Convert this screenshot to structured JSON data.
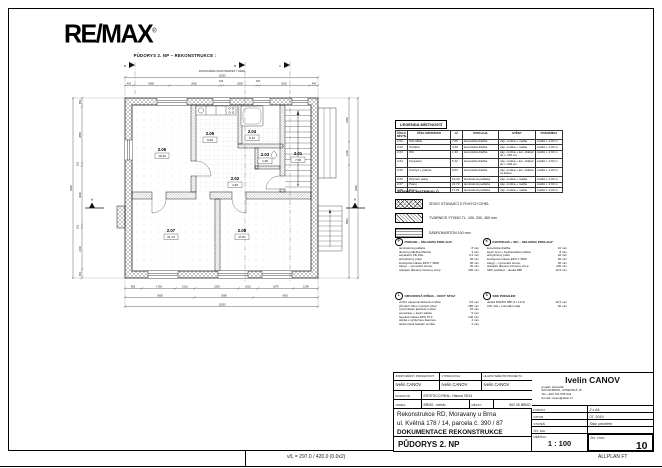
{
  "page": {
    "logo": "RE/MAX",
    "logo_reg": "®",
    "drawing_title": "PŮDORYS 2. NP – REKONSTRUKCE :",
    "footer_left": "v/L = 297.0 / 420.0 (0.0x2)",
    "footer_right": "ALLPLAN FT"
  },
  "plan": {
    "cut_note": "ROVINA ŘEZU NAD PARAPETY OKEN",
    "section_letter": "A",
    "flags": [
      "B",
      "B",
      "C"
    ],
    "rooms": [
      {
        "no": "2.01",
        "area": "7,06"
      },
      {
        "no": "2.02",
        "area": "4,49"
      },
      {
        "no": "2.03",
        "area": "1,30"
      },
      {
        "no": "2.04",
        "area": "5,12"
      },
      {
        "no": "2.05",
        "area": "6,03"
      },
      {
        "no": "2.06",
        "area": "19,43"
      },
      {
        "no": "2.07",
        "area": "21,73"
      },
      {
        "no": "2.08",
        "area": "17,81"
      }
    ],
    "dims": {
      "top_total": "10150",
      "top": [
        "450",
        "1880",
        "2650",
        "150",
        "1800",
        "150",
        "2620",
        "450"
      ],
      "bottom1": [
        "890",
        "1760",
        "1010",
        "2320",
        "1010",
        "1870",
        "1290"
      ],
      "bottom2": [
        "3650",
        "3080",
        "3420"
      ],
      "bottom_total": "10150",
      "left": [
        "450",
        "2890",
        "150",
        "3030",
        "150",
        "2140",
        "450"
      ],
      "left_total": "9260",
      "right": [
        "2250",
        "1200",
        "5810"
      ],
      "right_total": "9260"
    }
  },
  "legend_rooms": {
    "title": "LEGENDA MÍSTNOSTÍ",
    "columns": [
      "ČÍSLO MÍSTN.",
      "ÚČEL MÍSTNOSTI",
      "m²",
      "PODLAHA",
      "STĚNY",
      "POZNÁMKA"
    ],
    "rows": [
      [
        "2.01",
        "Schodiště",
        "7,06",
        "keramická dlažba",
        "váp. omítka + malba",
        "světlá v. 2,60 m"
      ],
      [
        "2.02",
        "Chodba",
        "4,49",
        "keramická dlažba",
        "váp. omítka + malba",
        "světlá v. 2,60 m"
      ],
      [
        "2.03",
        "WC",
        "1,30",
        "keramická dlažba",
        "váp. omítka + ker. obklad do v. 150 cm",
        "světlá v. 2,60 m"
      ],
      [
        "2.04",
        "Koupelna",
        "5,12",
        "keramická dlažba",
        "váp. omítka + ker. obklad do v. 200 cm",
        "světlá v. 2,60 m"
      ],
      [
        "2.05",
        "Kuchyň + jídelna",
        "6,03",
        "keramická dlažba",
        "váp. omítka + ker. obklad za linkou",
        "světlá v. 2,60 m"
      ],
      [
        "2.06",
        "Obývací pokoj",
        "19,43",
        "laminátová podlaha",
        "váp. omítka + malba",
        "světlá v. 2,60 m"
      ],
      [
        "2.07",
        "Pokoj",
        "21,73",
        "laminátová podlaha",
        "váp. omítka + malba",
        "světlá v. 2,60 m"
      ],
      [
        "2.08",
        "Pokoj",
        "17,81",
        "laminátová podlaha",
        "váp. omítka + malba",
        "světlá v. 2,60 m"
      ]
    ]
  },
  "legend_materials": {
    "title": "LEGENDA MATERIÁLŮ",
    "items": [
      {
        "hatch": "cross",
        "label": "ZDIVO STÁVAJÍCÍ Z PLNÝCH CIHEL"
      },
      {
        "hatch": "diag",
        "label": "TVÁRNICE YTONG TL. 100, 200, 450 mm"
      },
      {
        "hatch": "lines",
        "label": "SÁDROKARTON 100 mm"
      }
    ]
  },
  "notes": [
    {
      "key": "P",
      "title": "POKOJE – SKLADBA PODLAHY:",
      "items": [
        [
          "laminátová podlaha",
          "8 mm"
        ],
        [
          "tlumicí podložka Mirelon",
          "3 mm"
        ],
        [
          "separační PE fólie",
          "0,2 mm"
        ],
        [
          "anhydritový potěr",
          "45 mm"
        ],
        [
          "kročejová izolace EPS T 3500",
          "30 mm"
        ],
        [
          "zásyp – vyrovnání stropu",
          "20 mm"
        ],
        [
          "stávající dřevěný trámový strop",
          "220 mm"
        ]
      ]
    },
    {
      "key": "K",
      "title": "KOUPELNA + WC – SKLADBA PODLAHY:",
      "items": [
        [
          "keramická dlažba",
          "10 mm"
        ],
        [
          "lepicí tmel + hydroizolační stěrka",
          "8 mm"
        ],
        [
          "anhydritový potěr",
          "42 mm"
        ],
        [
          "kročejová izolace EPS T 3500",
          "30 mm"
        ],
        [
          "zásyp – vyrovnání stropu",
          "20 mm"
        ],
        [
          "stávající dřevěný trámový strop",
          "220 mm"
        ],
        [
          "SDK podhled – deska RBI",
          "12,5 mm"
        ]
      ]
    },
    {
      "key": "L",
      "title": "OBVODOVÁ STĚNA – NOVÝ STAV:",
      "items": [
        [
          "vnitřní vápenná štuková omítka",
          "4,5 mm"
        ],
        [
          "původní zdivo z plných cihel",
          "450 mm"
        ],
        [
          "vyrovnávací jádrová omítka",
          "15 mm"
        ],
        [
          "penetrace + lepicí stěrka",
          "5 mm"
        ],
        [
          "tepelná izolace EPS 70 F",
          "140 mm"
        ],
        [
          "stěrka s výztužnou tkaninou",
          "4 mm"
        ],
        [
          "tenkovrstvá fasádní omítka",
          "2 mm"
        ]
      ]
    },
    {
      "key": "S",
      "title": "SDK PODHLED:",
      "items": [
        [
          "deska RIGIPS RBI (1× 12,5)",
          "12,5 mm"
        ],
        [
          "CW rošt + minerální vata",
          "60 mm"
        ]
      ]
    }
  ],
  "titleblock": {
    "responsible_label": "ZODPOVĚDNÝ PROJEKTANT",
    "responsible": "Ivelin CANOV",
    "drafted_label": "VYPRACOVAL",
    "drafted": "Ivelin CANOV",
    "chief_label": "HLAVNÍ INŽENÝR PROJEKTU",
    "chief": "Ivelin CANOV",
    "investor_label": "INVESTOR",
    "investor": "ESTETICO REAL, Hálova 78/14",
    "district_label": "OKRES",
    "district": "BRNO - město",
    "city_label": "MĚSTO",
    "city": "602 00 BRNO",
    "project_line1": "Rekonstrukce RD, Moravany u Brna",
    "project_line2": "ul. Květná 178 / 14, parcela č. 390 / 87",
    "project_line3": "DOKUMENTACE REKONSTRUKCE",
    "drawing_name": "PŮDORYS 2. NP",
    "firm_name": "Ivelin CANOV",
    "firm_line1": "projekt. kancelář",
    "firm_line2": "602 00 BRNO, JOSEFSKÁ 15",
    "firm_line3": "Tel + 420 721 556 044",
    "firm_line4": "E-mail: canov@atlas.cz",
    "format_label": "FORMÁT",
    "format": "2 x A4",
    "date_label": "DATUM",
    "date": "07. 2019",
    "stage_label": "STUPEŇ",
    "stage": "Stav. povolení",
    "order_label": "ČÍS. ZAK.",
    "order": "",
    "scale_label": "MĚŘÍTKO",
    "scale": "1 : 100",
    "sheet_label": "ČÍS. VÝKR.",
    "sheet": "10"
  }
}
